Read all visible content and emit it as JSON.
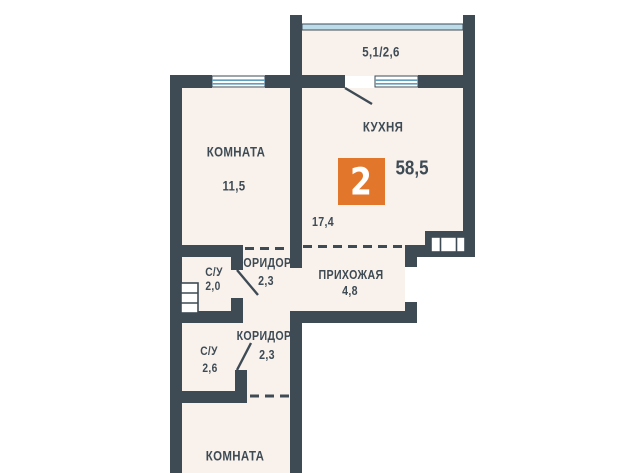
{
  "plan": {
    "badge": {
      "number": "2"
    },
    "total_area": "58,5",
    "balcony": {
      "area": "5,1/2,6"
    },
    "rooms": {
      "room_top": {
        "name": "КОМНАТА",
        "area": "11,5"
      },
      "kitchen": {
        "name": "КУХНЯ",
        "area": "17,4"
      },
      "corridor_upper": {
        "name": "КОРИДОР",
        "area": "2,3"
      },
      "bathroom_upper": {
        "name": "С/У",
        "area": "2,0"
      },
      "hallway": {
        "name": "ПРИХОЖАЯ",
        "area": "4,8"
      },
      "bathroom_lower": {
        "name": "С/У",
        "area": "2,6"
      },
      "corridor_lower": {
        "name": "КОРИДОР",
        "area": "2,3"
      },
      "room_bottom": {
        "name": "КОМНАТА"
      }
    },
    "colors": {
      "wall": "#3E4B55",
      "accent": "#E2772C",
      "interior": "#F9F1EB",
      "glazing": "#BDDCEA",
      "window_line": "#5E9FC0"
    }
  }
}
